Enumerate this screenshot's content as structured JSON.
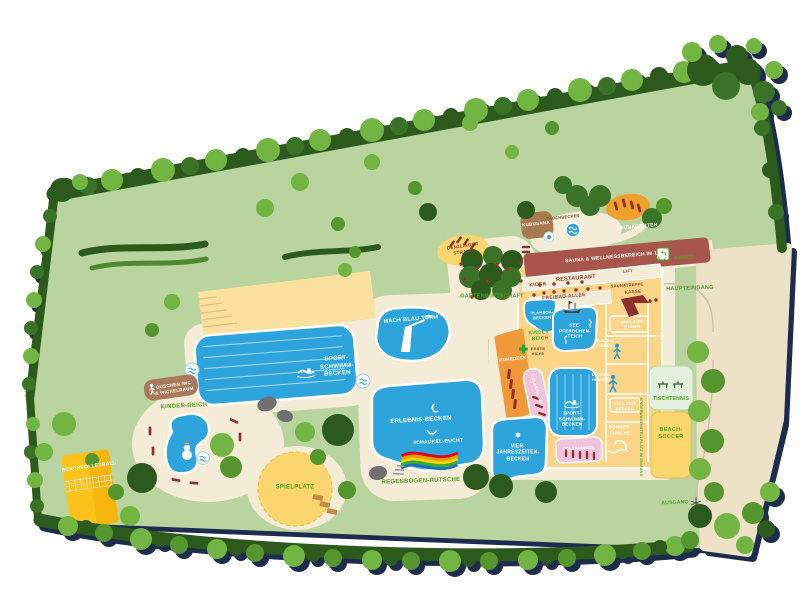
{
  "map": {
    "type": "illustrated-facility-map",
    "labels": {
      "beachvolleyball": "BEACHVOLLEYBALL",
      "duschen_wc": "DUSCHEN /WC\n& WICKELRAUM",
      "kinder_reich_outdoor": "KINDER-REICH",
      "spielplatz": "SPIELPLATZ",
      "sport_schwimm_becken_outdoor": "SPORT-\nSCHWIMM-\nBECKEN",
      "mach_blau_turm": "MACH`BLAU-TURM",
      "erlebnis_becken": "ERLEBNIS-BECKEN",
      "schaukel_bucht": "SCHAUKEL-BUCHT",
      "regenbogen_rutsche": "REGENBOGEN-RUTSCHE",
      "vier_jahreszeiten_becken": "VIER-\nJAHRESZEITEN-\nBECKEN",
      "gartenwirtschaft": "GARTENWIRTSCHAFT",
      "denzlinger_strand": "DENZLINGER\nSTRAND",
      "kubusana": "KUBUSANA",
      "tauchbecken": "TAUCHBECKEN",
      "saunagarten": "SAUNAGARTEN",
      "sauna_wellness": "SAUNA & WELLNESSBEREICH IM 1. OG",
      "rampe": "RAMPE",
      "kiosk": "KIOSK",
      "restaurant": "RESTAURANT",
      "lift": "LIFT",
      "freibad_allee": "FREIBAD-ALLEE",
      "saunatreppe": "SAUNATREPPE",
      "kasse": "KASSE",
      "haupteingang": "HAUPTEINGANG",
      "plansch_becken": "PLANSCH-\nBECKEN",
      "kinder_reich_indoor": "KINDER-\nREICH",
      "seepferdchen_teich": "SEE-\nPFERDCHEN-\nTEICH",
      "erste_hilfe": "ERSTE\nHILFE",
      "ruhedeck": "RUHEDECK",
      "relaxhimmel_1": "RELAXHIMMEL",
      "sport_schwimm_becken_indoor": "SPORT-\nSCHWIMM-\nBECKEN",
      "relaxhimmel_2": "RELAXHIMMEL",
      "sonnen_dusche": "SONNEN-\nDUSCHE",
      "dusche_damen": "DUSCHE\nDAMEN",
      "umkleide_damen": "UMKLEIDE\nDAMEN",
      "dusche_herren": "DUSCHE\nHERREN",
      "umkleide_herren": "UMKLEIDE\nHERREN",
      "tischtennis": "TISCHTENNIS",
      "beach_soccer": "BEACH-\nSOCCER",
      "kinderwagen_stellplatz": "KINDERWAGENSTELLPLATZ IM EINGANG",
      "ausgang": "AUSGANG"
    },
    "icons": {
      "snowflake": "❄"
    },
    "colors": {
      "lawn": "#b9d49e",
      "tree_bright": "#72b543",
      "tree_dark": "#2c5a1d",
      "path_sand": "#f4ecd6",
      "walkway_beige": "#eee2c6",
      "pool_blue": "#2da4dc",
      "building_yellow": "#fbd488",
      "sauna_red": "#a8564c",
      "lounger_red": "#8e2f2b",
      "relax_pink": "#f3c3dc",
      "deck_orange": "#f0993a",
      "court_yellow": "#fec31a",
      "sand_yellow": "#fbd56e",
      "label_green": "#50a028",
      "label_darkred": "#8c3b2e",
      "shadow_navy": "#1d2c4e"
    }
  }
}
